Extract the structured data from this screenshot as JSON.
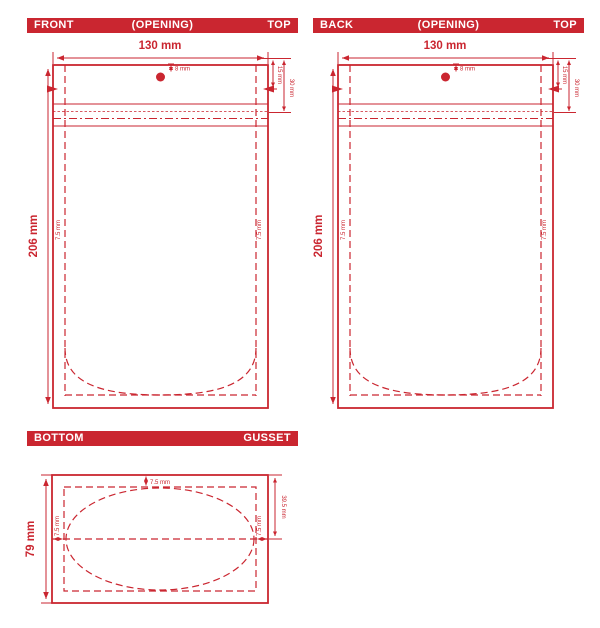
{
  "colors": {
    "dieline_red": "#ca2630",
    "background": "#ffffff"
  },
  "panels": {
    "front": {
      "header": {
        "left": "FRONT",
        "center": "(OPENING)",
        "right": "TOP"
      }
    },
    "back": {
      "header": {
        "left": "BACK",
        "center": "(OPENING)",
        "right": "TOP"
      }
    },
    "bottom": {
      "header": {
        "left": "BOTTOM",
        "right": "GUSSET"
      }
    }
  },
  "dims": {
    "width": "130 mm",
    "height": "206 mm",
    "hole": "8 mm",
    "notch_offset": "15 mm",
    "zipper_offset": "30 mm",
    "seal": "7.5 mm",
    "gusset_height": "79 mm",
    "gusset_half": "39.5 mm"
  }
}
